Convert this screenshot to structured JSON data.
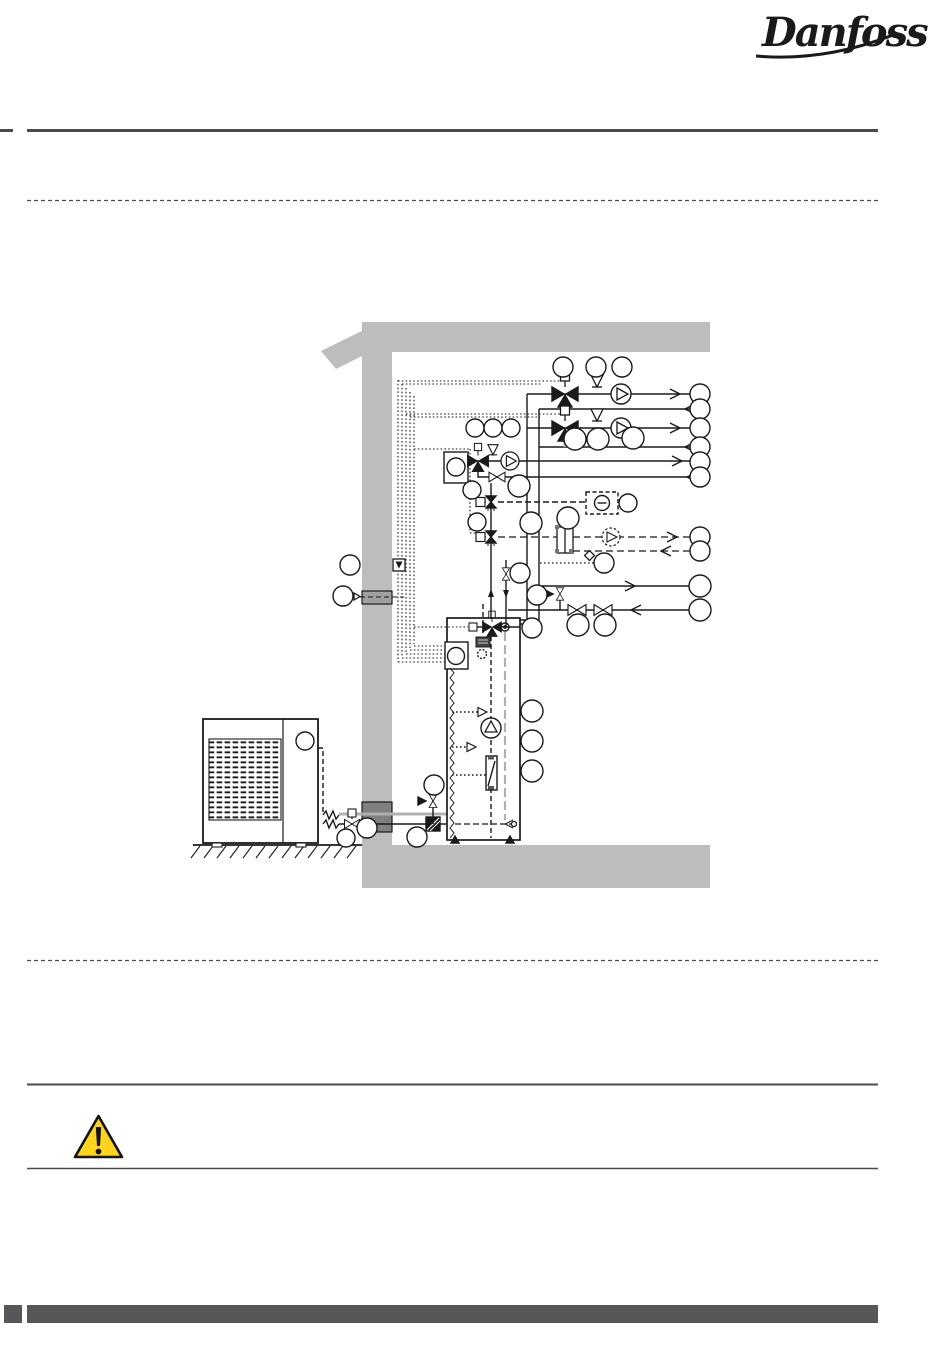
{
  "header": {
    "logo_text": "Danfoss"
  },
  "rules": {
    "top_solid": true,
    "top_dashed": true,
    "bottom_dashed": true,
    "note_top_solid": true,
    "note_bottom_solid": true
  },
  "warning": {
    "icon": "warning-triangle-icon",
    "color": "#ffd41f",
    "border_color": "#141414"
  },
  "footer": {
    "bar_color": "#57575a"
  },
  "colors": {
    "rule_dark": "#4a4a4c",
    "wall_gray": "#bdbdbd",
    "wall_duct_dark": "#808080",
    "wall_duct_mid": "#a0a0a0",
    "line_black": "#1a1a1a",
    "pipe_gray": "#b0b0b0",
    "footer_gray": "#57575a",
    "warning_yellow": "#ffd41f"
  },
  "diagram": {
    "type": "heat-pump-installation-schematic",
    "elements": [
      "roof-beam",
      "ceiling",
      "house-wall",
      "floor-slab",
      "ground-hatch",
      "wall-duct",
      "outdoor-heat-pump-unit",
      "fan-grille",
      "flexible-hose",
      "indoor-tank-unit",
      "controller-box",
      "immersion-coil",
      "flow-meter",
      "three-way-mixing-valve",
      "valve-actuator",
      "check-valve",
      "shut-off-valve",
      "motorized-valve",
      "safety-valve",
      "filter-strainer",
      "heat-exchanger",
      "circulation-pump",
      "recirculation-pump",
      "room-thermostat",
      "room-sensor",
      "sensor-cable-bundle",
      "flow-arrow",
      "callout-circle"
    ]
  }
}
